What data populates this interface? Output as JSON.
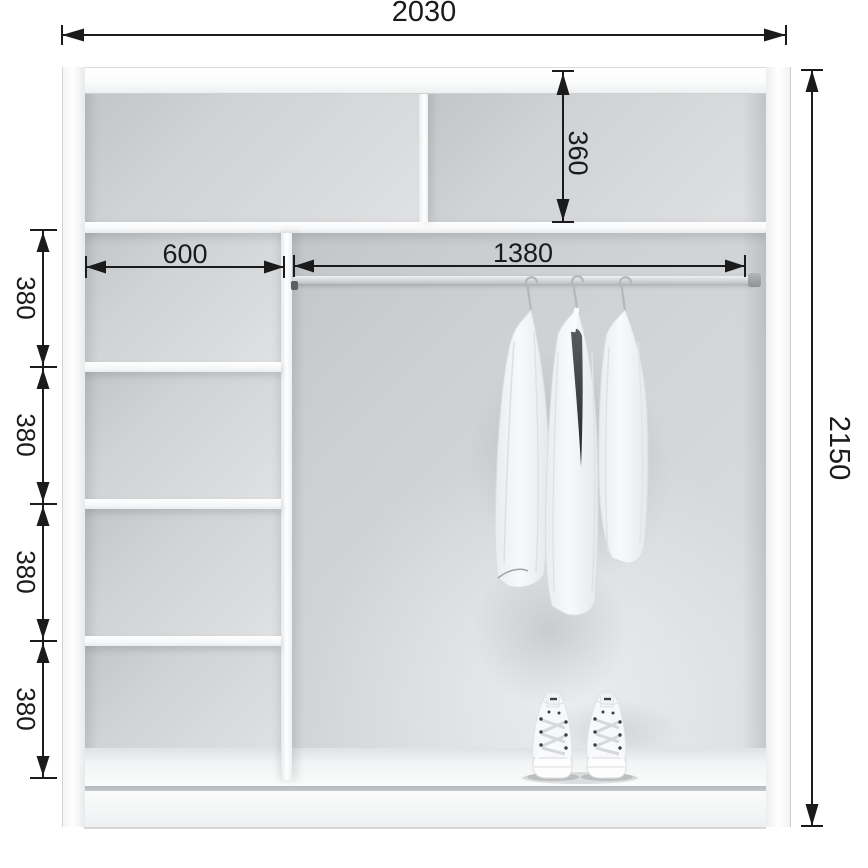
{
  "title": "Wardrobe interior dimensions diagram",
  "unit": "mm",
  "labels": {
    "total_width": "2030",
    "total_height": "2150",
    "top_compartment_height": "360",
    "left_column_width": "600",
    "rod_length": "1380",
    "shelf_gaps": [
      "380",
      "380",
      "380",
      "380"
    ]
  },
  "components": {
    "top_shelf": "full-width top shelf",
    "top_divider": "vertical divider in top compartment",
    "left_column": "shelf column with four compartments",
    "hanging_rod": "clothes rail",
    "garments": "three white garments on hangers",
    "shoes": "pair of white high-top sneakers"
  },
  "colors": {
    "dimension_lines": "#1b1b1b",
    "cabinet_face": "#ffffff",
    "interior_wall": "#d2d5d7",
    "rod": "#c9cccf"
  }
}
